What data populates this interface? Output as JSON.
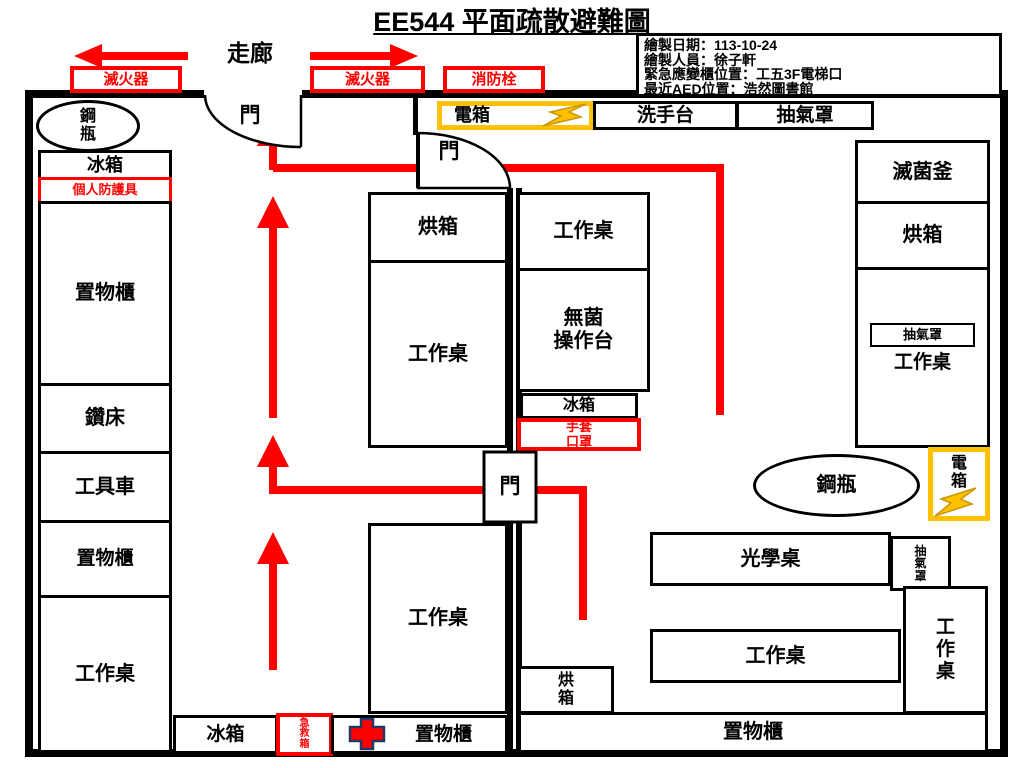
{
  "title": "EE544 平面疏散避難圖",
  "info": {
    "date": "繪製日期：113-10-24",
    "author": "繪製人員：徐子軒",
    "cabinet": "緊急應變櫃位置：工五3F電梯口",
    "aed": "最近AED位置：浩然圖書館"
  },
  "corridor_label": "走廊",
  "safety": {
    "extinguisher_left": "滅火器",
    "extinguisher_mid": "滅火器",
    "hydrant": "消防栓",
    "ppe": "個人防護具",
    "first_aid": "急\n救\n箱",
    "gloves_masks": "手套\n口罩"
  },
  "doors": {
    "door1": "門",
    "door2": "門",
    "door3": "門"
  },
  "left_room": {
    "cylinder": "鋼\n瓶",
    "fridge_top": "冰箱",
    "cabinet1": "置物櫃",
    "drill": "鑽床",
    "toolcart": "工具車",
    "cabinet2": "置物櫃",
    "worktable_left": "工作桌",
    "oven_mid": "烘箱",
    "worktable_mid": "工作桌",
    "worktable_bottom": "工作桌",
    "fridge_bottom": "冰箱",
    "cabinet_bottom": "置物櫃"
  },
  "right_room": {
    "panel_top": "電箱",
    "sink": "洗手台",
    "hood_top": "抽氣罩",
    "worktable_ne": "工作桌",
    "sterile_bench": "無菌\n操作台",
    "fridge_small": "冰箱",
    "autoclave": "滅菌釜",
    "oven_right": "烘箱",
    "hood_small_right": "抽氣罩",
    "worktable_right": "工作桌",
    "cylinder": "鋼瓶",
    "panel_right": "電\n箱",
    "optical_table": "光學桌",
    "hood_small_bottom": "抽\n氣\n罩",
    "worktable_south": "工作桌",
    "worktable_vertical": "工\n作\n桌",
    "cabinet_wide": "置物櫃",
    "oven_small": "烘\n箱"
  },
  "colors": {
    "route_red": "#FF0000",
    "panel_yellow": "#FFC000",
    "cross_navy": "#203864",
    "bolt_gold": "#FFC000"
  }
}
